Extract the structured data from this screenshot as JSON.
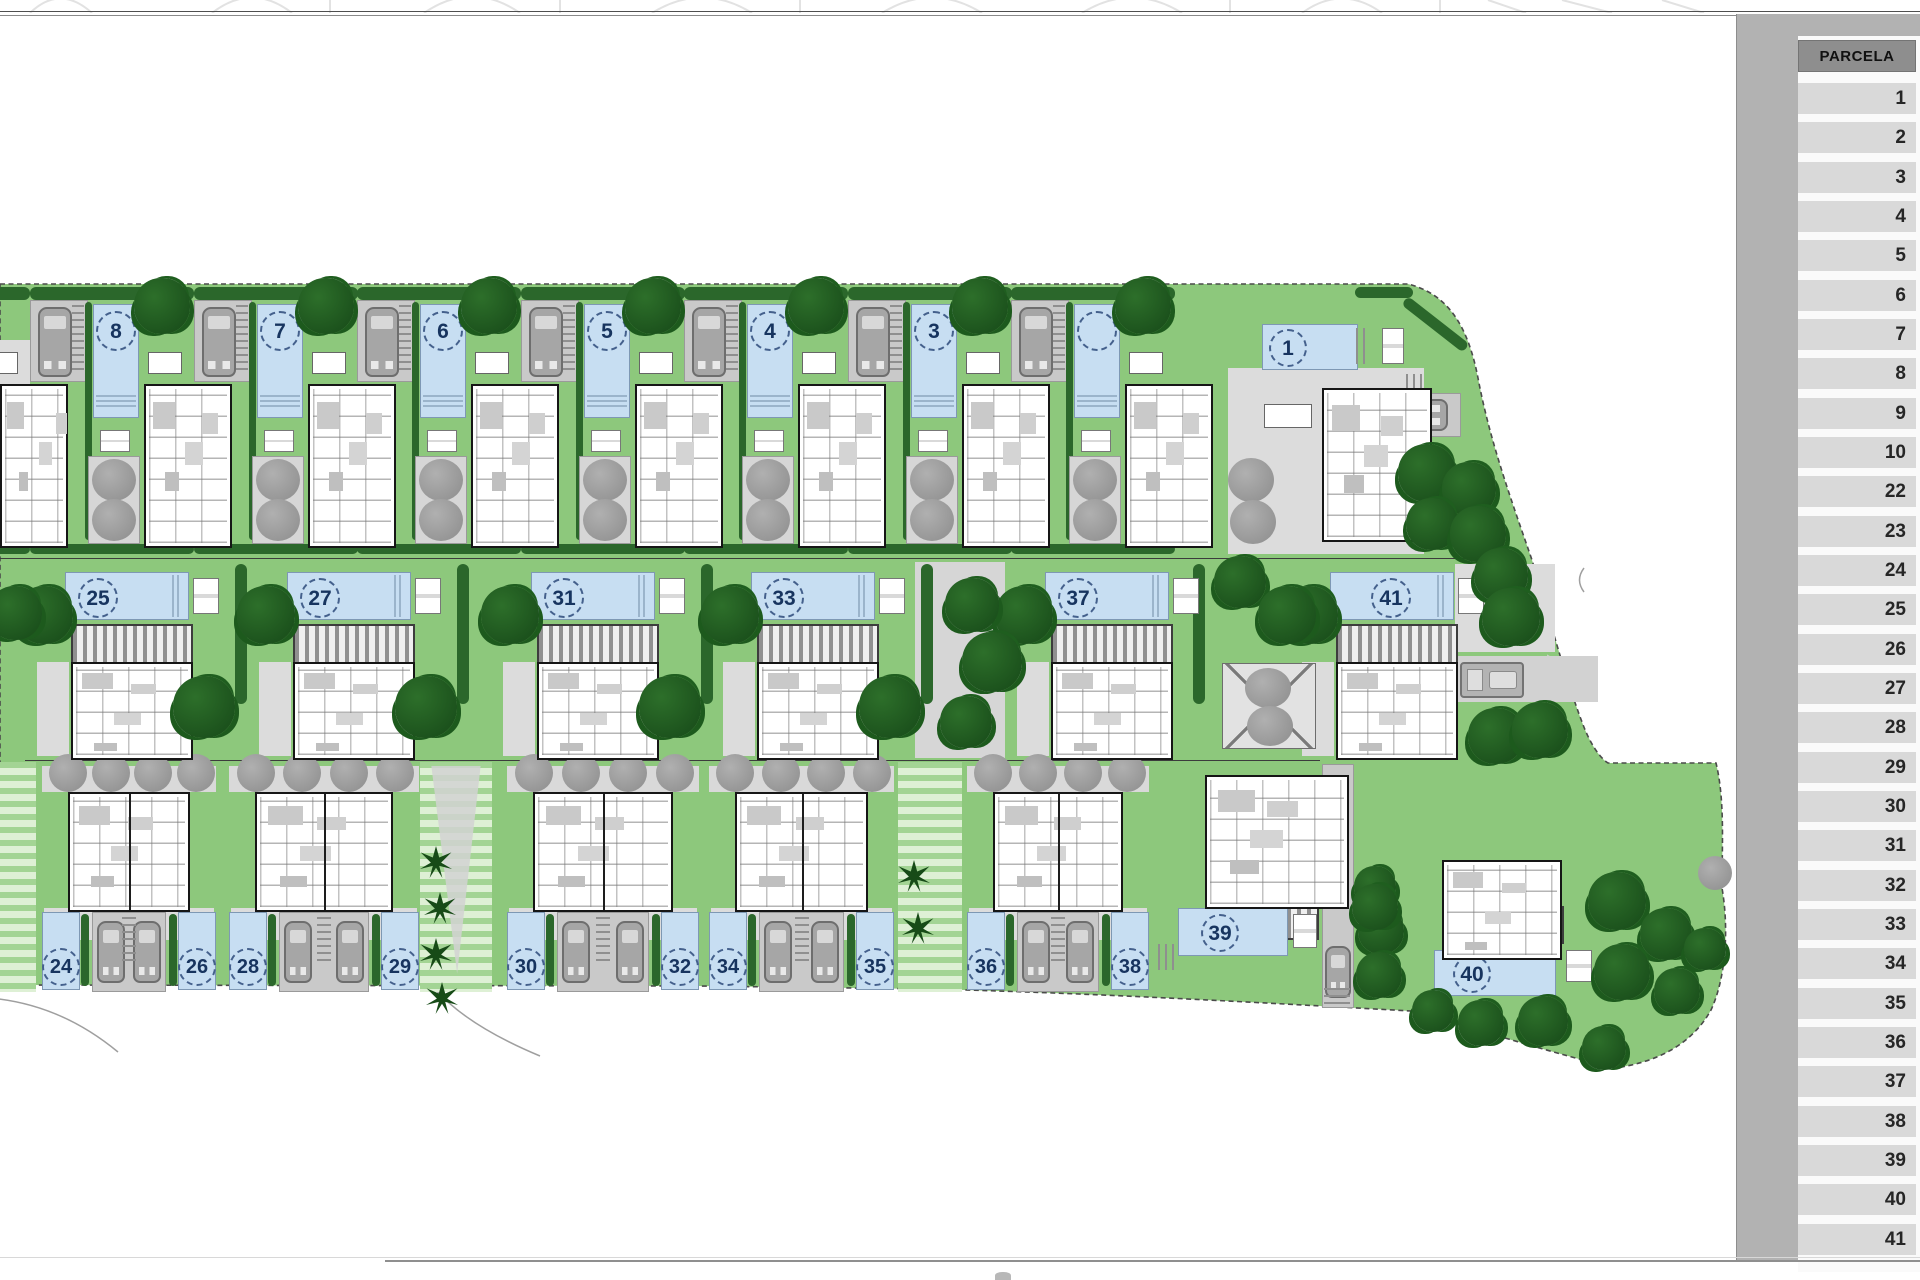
{
  "parcela_table": {
    "header": "PARCELA",
    "rows": [
      "1",
      "2",
      "3",
      "4",
      "5",
      "6",
      "7",
      "8",
      "9",
      "10",
      "22",
      "23",
      "24",
      "25",
      "26",
      "27",
      "28",
      "29",
      "30",
      "31",
      "32",
      "33",
      "34",
      "35",
      "36",
      "37",
      "38",
      "39",
      "40",
      "41"
    ]
  },
  "plan": {
    "top_lots": [
      {
        "label": "8"
      },
      {
        "label": "7"
      },
      {
        "label": "6"
      },
      {
        "label": "5"
      },
      {
        "label": "4"
      },
      {
        "label": "3"
      },
      {
        "label": "2"
      }
    ],
    "corner_lot": {
      "label": "1"
    },
    "middle_lots": [
      {
        "label": "25"
      },
      {
        "label": "27"
      },
      {
        "label": "31"
      },
      {
        "label": "33"
      },
      {
        "label": "37"
      },
      {
        "label": "41"
      }
    ],
    "bottom_pairs": [
      {
        "left_label": "24",
        "right_label": "26"
      },
      {
        "left_label": "28",
        "right_label": "29"
      },
      {
        "left_label": "30",
        "right_label": "32"
      },
      {
        "left_label": "34",
        "right_label": "35"
      },
      {
        "left_label": "36",
        "right_label": "38"
      }
    ],
    "detached_lots": [
      {
        "label": "39"
      },
      {
        "label": "40"
      }
    ]
  },
  "colors": {
    "lawn": "#8dc87c",
    "tree_dark": "#1d5a1d",
    "pool_blue": "#c7def2",
    "paving": "#c9c9c9",
    "terrace": "#dcdcdc",
    "sidebar_bg": "#b2b2b2",
    "header_cell": "#8e8e8e",
    "row_cell": "#d9d9d9"
  }
}
